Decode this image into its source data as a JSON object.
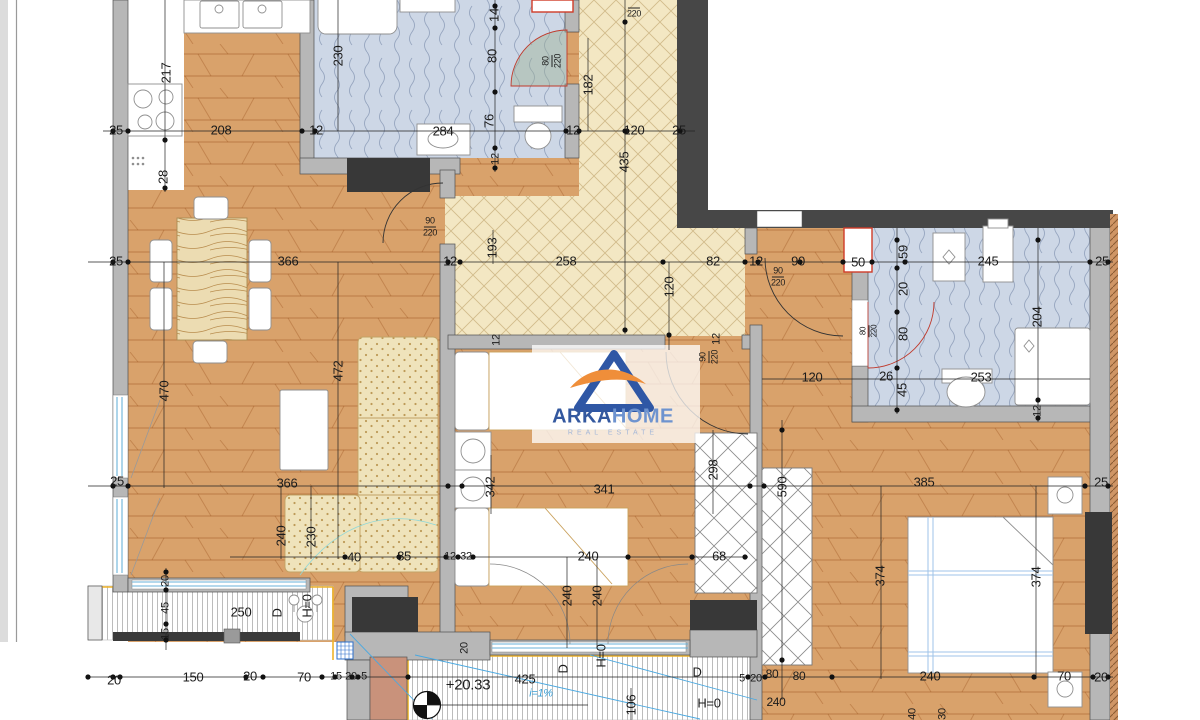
{
  "logo": {
    "brand_part1": "ARKA",
    "brand_part2": "HOME",
    "tagline": "REAL ESTATE",
    "color_primary": "#33589f",
    "color_secondary": "#6e93cf",
    "color_accent": "#ef8e3a",
    "tagline_color": "#a4b7d8"
  },
  "level_marker": {
    "value": "+20.33"
  },
  "slope_note": {
    "value": "i=1%",
    "color": "#3aa0d8"
  },
  "colors": {
    "wood": "#d9a26b",
    "hall_tile": "#f3e7c3",
    "bath_tile": "#cdd7e6",
    "wall_light": "#b7b7b7",
    "wall_dark": "#474747",
    "block_dark": "#383838",
    "shaft_red": "#cf3b28",
    "balcony_border": "#f0b429",
    "glass_blue": "#6ab2d8",
    "slope_blue": "#4aa8e0",
    "pillar_terracotta": "#c9927b"
  },
  "dimension_labels": [
    {
      "t": "25",
      "x": 116,
      "y": 130
    },
    {
      "t": "208",
      "x": 221,
      "y": 130
    },
    {
      "t": "12",
      "x": 316,
      "y": 130
    },
    {
      "t": "284",
      "x": 443,
      "y": 131
    },
    {
      "t": "12",
      "x": 573,
      "y": 130
    },
    {
      "t": "120",
      "x": 634,
      "y": 130
    },
    {
      "t": "25",
      "x": 679,
      "y": 130
    },
    {
      "t": "217",
      "x": 166,
      "y": 73,
      "r": 1
    },
    {
      "t": "28",
      "x": 163,
      "y": 177,
      "r": 1
    },
    {
      "t": "230",
      "x": 338,
      "y": 56,
      "r": 1
    },
    {
      "t": "14",
      "x": 494,
      "y": 15,
      "r": 1
    },
    {
      "t": "80",
      "x": 492,
      "y": 56,
      "r": 1
    },
    {
      "t": "76",
      "x": 489,
      "y": 121,
      "r": 1
    },
    {
      "t": "12",
      "x": 496,
      "y": 159,
      "r": 1,
      "s": 11
    },
    {
      "t": "182",
      "x": 588,
      "y": 85,
      "r": 1
    },
    {
      "t": "435",
      "x": 624,
      "y": 162,
      "r": 1
    },
    {
      "t": "80/220",
      "x": 552,
      "y": 61,
      "r": 1,
      "s": 9
    },
    {
      "t": "/220",
      "x": 634,
      "y": 10,
      "s": 9
    },
    {
      "t": "25",
      "x": 116,
      "y": 261
    },
    {
      "t": "366",
      "x": 288,
      "y": 261
    },
    {
      "t": "12",
      "x": 450,
      "y": 261
    },
    {
      "t": "193",
      "x": 492,
      "y": 248,
      "r": 1
    },
    {
      "t": "258",
      "x": 566,
      "y": 261
    },
    {
      "t": "82",
      "x": 713,
      "y": 261
    },
    {
      "t": "12",
      "x": 756,
      "y": 261
    },
    {
      "t": "90",
      "x": 798,
      "y": 261
    },
    {
      "t": "90/220",
      "x": 778,
      "y": 277,
      "s": 9
    },
    {
      "t": "120",
      "x": 669,
      "y": 287,
      "r": 1
    },
    {
      "t": "50",
      "x": 858,
      "y": 262
    },
    {
      "t": "245",
      "x": 988,
      "y": 261
    },
    {
      "t": "25",
      "x": 1102,
      "y": 261
    },
    {
      "t": "12",
      "x": 497,
      "y": 340,
      "r": 1,
      "s": 11
    },
    {
      "t": "12",
      "x": 717,
      "y": 339,
      "r": 1,
      "s": 11
    },
    {
      "t": "90/220",
      "x": 709,
      "y": 357,
      "r": 1,
      "s": 9
    },
    {
      "t": "90/220",
      "x": 430,
      "y": 227,
      "s": 9
    },
    {
      "t": "59",
      "x": 903,
      "y": 252,
      "r": 1
    },
    {
      "t": "20",
      "x": 903,
      "y": 289,
      "r": 1
    },
    {
      "t": "80",
      "x": 903,
      "y": 334,
      "r": 1
    },
    {
      "t": "80/220",
      "x": 869,
      "y": 331,
      "r": 1,
      "s": 8
    },
    {
      "t": "26",
      "x": 886,
      "y": 376
    },
    {
      "t": "45",
      "x": 902,
      "y": 390,
      "r": 1
    },
    {
      "t": "120",
      "x": 812,
      "y": 377
    },
    {
      "t": "253",
      "x": 981,
      "y": 377
    },
    {
      "t": "204",
      "x": 1037,
      "y": 317,
      "r": 1
    },
    {
      "t": "12",
      "x": 1038,
      "y": 411,
      "r": 1,
      "s": 11
    },
    {
      "t": "25",
      "x": 117,
      "y": 481
    },
    {
      "t": "366",
      "x": 287,
      "y": 483
    },
    {
      "t": "470",
      "x": 164,
      "y": 391,
      "r": 1
    },
    {
      "t": "472",
      "x": 338,
      "y": 371,
      "r": 1
    },
    {
      "t": "342",
      "x": 490,
      "y": 487,
      "r": 1
    },
    {
      "t": "341",
      "x": 604,
      "y": 489
    },
    {
      "t": "298",
      "x": 713,
      "y": 470,
      "r": 1
    },
    {
      "t": "590",
      "x": 782,
      "y": 487,
      "r": 1
    },
    {
      "t": "385",
      "x": 924,
      "y": 482
    },
    {
      "t": "25",
      "x": 1101,
      "y": 482
    },
    {
      "t": "374",
      "x": 880,
      "y": 576,
      "r": 1
    },
    {
      "t": "374",
      "x": 1036,
      "y": 577,
      "r": 1
    },
    {
      "t": "240",
      "x": 281,
      "y": 536,
      "r": 1
    },
    {
      "t": "230",
      "x": 311,
      "y": 537,
      "r": 1
    },
    {
      "t": "40",
      "x": 354,
      "y": 557
    },
    {
      "t": "85",
      "x": 404,
      "y": 556
    },
    {
      "t": "12",
      "x": 450,
      "y": 557,
      "s": 11
    },
    {
      "t": "32",
      "x": 466,
      "y": 557,
      "s": 11
    },
    {
      "t": "240",
      "x": 588,
      "y": 556
    },
    {
      "t": "68",
      "x": 719,
      "y": 556
    },
    {
      "t": "240",
      "x": 567,
      "y": 596,
      "r": 1
    },
    {
      "t": "240",
      "x": 597,
      "y": 596,
      "r": 1
    },
    {
      "t": "20",
      "x": 465,
      "y": 648,
      "r": 1,
      "s": 11
    },
    {
      "t": "20",
      "x": 166,
      "y": 581,
      "r": 1,
      "s": 11
    },
    {
      "t": "45",
      "x": 166,
      "y": 608,
      "r": 1,
      "s": 11
    },
    {
      "t": "15",
      "x": 166,
      "y": 634,
      "r": 1,
      "s": 11
    },
    {
      "t": "250",
      "x": 241,
      "y": 612
    },
    {
      "t": "D",
      "x": 277,
      "y": 613,
      "r": 1
    },
    {
      "t": "H=0",
      "x": 307,
      "y": 606,
      "r": 1
    },
    {
      "t": "20",
      "x": 114,
      "y": 680
    },
    {
      "t": "150",
      "x": 193,
      "y": 677
    },
    {
      "t": "20",
      "x": 250,
      "y": 676
    },
    {
      "t": "70",
      "x": 304,
      "y": 677
    },
    {
      "t": "15",
      "x": 336,
      "y": 677,
      "s": 11
    },
    {
      "t": "20",
      "x": 351,
      "y": 677,
      "s": 11
    },
    {
      "t": "5",
      "x": 364,
      "y": 677,
      "s": 11
    },
    {
      "t": "+20.33",
      "x": 468,
      "y": 685,
      "s": 15
    },
    {
      "t": "425",
      "x": 525,
      "y": 679
    },
    {
      "t": "i=1%",
      "x": 541,
      "y": 694,
      "s": 11,
      "c": "#3aa0d8",
      "i": 1
    },
    {
      "t": "D",
      "x": 563,
      "y": 669,
      "r": 1
    },
    {
      "t": "H=0",
      "x": 601,
      "y": 656,
      "r": 1
    },
    {
      "t": "106",
      "x": 631,
      "y": 705,
      "r": 1
    },
    {
      "t": "D",
      "x": 697,
      "y": 672
    },
    {
      "t": "H=0",
      "x": 709,
      "y": 703
    },
    {
      "t": "5",
      "x": 742,
      "y": 679,
      "s": 11
    },
    {
      "t": "20",
      "x": 756,
      "y": 679,
      "s": 11
    },
    {
      "t": "80",
      "x": 772,
      "y": 674,
      "s": 12
    },
    {
      "t": "80",
      "x": 799,
      "y": 676,
      "s": 12
    },
    {
      "t": "240",
      "x": 776,
      "y": 702,
      "s": 12
    },
    {
      "t": "240",
      "x": 930,
      "y": 676
    },
    {
      "t": "70",
      "x": 1064,
      "y": 676
    },
    {
      "t": "20",
      "x": 1101,
      "y": 677
    },
    {
      "t": "40",
      "x": 913,
      "y": 714,
      "r": 1,
      "s": 11
    },
    {
      "t": "30",
      "x": 943,
      "y": 714,
      "r": 1,
      "s": 11
    }
  ],
  "dim_lines": [
    [
      103,
      131,
      695,
      131
    ],
    [
      88,
      262,
      1113,
      262
    ],
    [
      88,
      486,
      1113,
      486
    ],
    [
      230,
      557,
      748,
      557
    ],
    [
      88,
      677,
      1113,
      677
    ],
    [
      495,
      0,
      495,
      172
    ],
    [
      625,
      0,
      625,
      334
    ],
    [
      588,
      38,
      588,
      131
    ],
    [
      338,
      0,
      338,
      131
    ],
    [
      165,
      0,
      165,
      192
    ],
    [
      493,
      230,
      493,
      264
    ],
    [
      669,
      262,
      669,
      350
    ],
    [
      897,
      228,
      897,
      414
    ],
    [
      1038,
      228,
      1038,
      422
    ],
    [
      762,
      379,
      1090,
      379
    ],
    [
      164,
      262,
      164,
      488
    ],
    [
      338,
      262,
      338,
      559
    ],
    [
      281,
      486,
      281,
      559
    ],
    [
      311,
      486,
      311,
      559
    ],
    [
      491,
      455,
      491,
      514
    ],
    [
      713,
      430,
      713,
      514
    ],
    [
      782,
      420,
      782,
      700
    ],
    [
      881,
      486,
      881,
      679
    ],
    [
      1036,
      486,
      1036,
      679
    ],
    [
      567,
      557,
      567,
      648
    ],
    [
      597,
      557,
      597,
      648
    ],
    [
      166,
      568,
      166,
      650
    ],
    [
      631,
      688,
      631,
      720
    ],
    [
      427,
      705,
      588,
      705
    ]
  ],
  "dim_ticks": [
    [
      113,
      131
    ],
    [
      128,
      131
    ],
    [
      302,
      131
    ],
    [
      315,
      131
    ],
    [
      566,
      131
    ],
    [
      579,
      131
    ],
    [
      627,
      131
    ],
    [
      680,
      131
    ],
    [
      113,
      262
    ],
    [
      128,
      262
    ],
    [
      448,
      262
    ],
    [
      460,
      262
    ],
    [
      663,
      262
    ],
    [
      745,
      262
    ],
    [
      758,
      262
    ],
    [
      800,
      262
    ],
    [
      843,
      262
    ],
    [
      872,
      262
    ],
    [
      905,
      262
    ],
    [
      1090,
      262
    ],
    [
      1108,
      262
    ],
    [
      113,
      486
    ],
    [
      128,
      486
    ],
    [
      448,
      486
    ],
    [
      462,
      486
    ],
    [
      750,
      486
    ],
    [
      764,
      486
    ],
    [
      1085,
      486
    ],
    [
      1108,
      486
    ],
    [
      345,
      557
    ],
    [
      399,
      557
    ],
    [
      446,
      557
    ],
    [
      458,
      557
    ],
    [
      473,
      557
    ],
    [
      628,
      557
    ],
    [
      692,
      557
    ],
    [
      745,
      557
    ],
    [
      88,
      677
    ],
    [
      113,
      677
    ],
    [
      120,
      677
    ],
    [
      246,
      677
    ],
    [
      263,
      677
    ],
    [
      322,
      677
    ],
    [
      335,
      677
    ],
    [
      352,
      677
    ],
    [
      358,
      677
    ],
    [
      408,
      677
    ],
    [
      748,
      677
    ],
    [
      765,
      677
    ],
    [
      832,
      677
    ],
    [
      1034,
      677
    ],
    [
      1093,
      677
    ],
    [
      1108,
      677
    ],
    [
      495,
      6
    ],
    [
      495,
      28
    ],
    [
      495,
      92
    ],
    [
      495,
      148
    ],
    [
      495,
      168
    ],
    [
      625,
      22
    ],
    [
      625,
      131
    ],
    [
      625,
      330
    ],
    [
      165,
      140
    ],
    [
      165,
      188
    ],
    [
      897,
      240
    ],
    [
      897,
      268
    ],
    [
      897,
      312
    ],
    [
      897,
      368
    ],
    [
      897,
      410
    ],
    [
      1038,
      240
    ],
    [
      1038,
      400
    ],
    [
      1038,
      418
    ],
    [
      669,
      335
    ],
    [
      166,
      572
    ],
    [
      166,
      590
    ],
    [
      166,
      624
    ],
    [
      166,
      640
    ],
    [
      782,
      430
    ],
    [
      782,
      660
    ]
  ]
}
